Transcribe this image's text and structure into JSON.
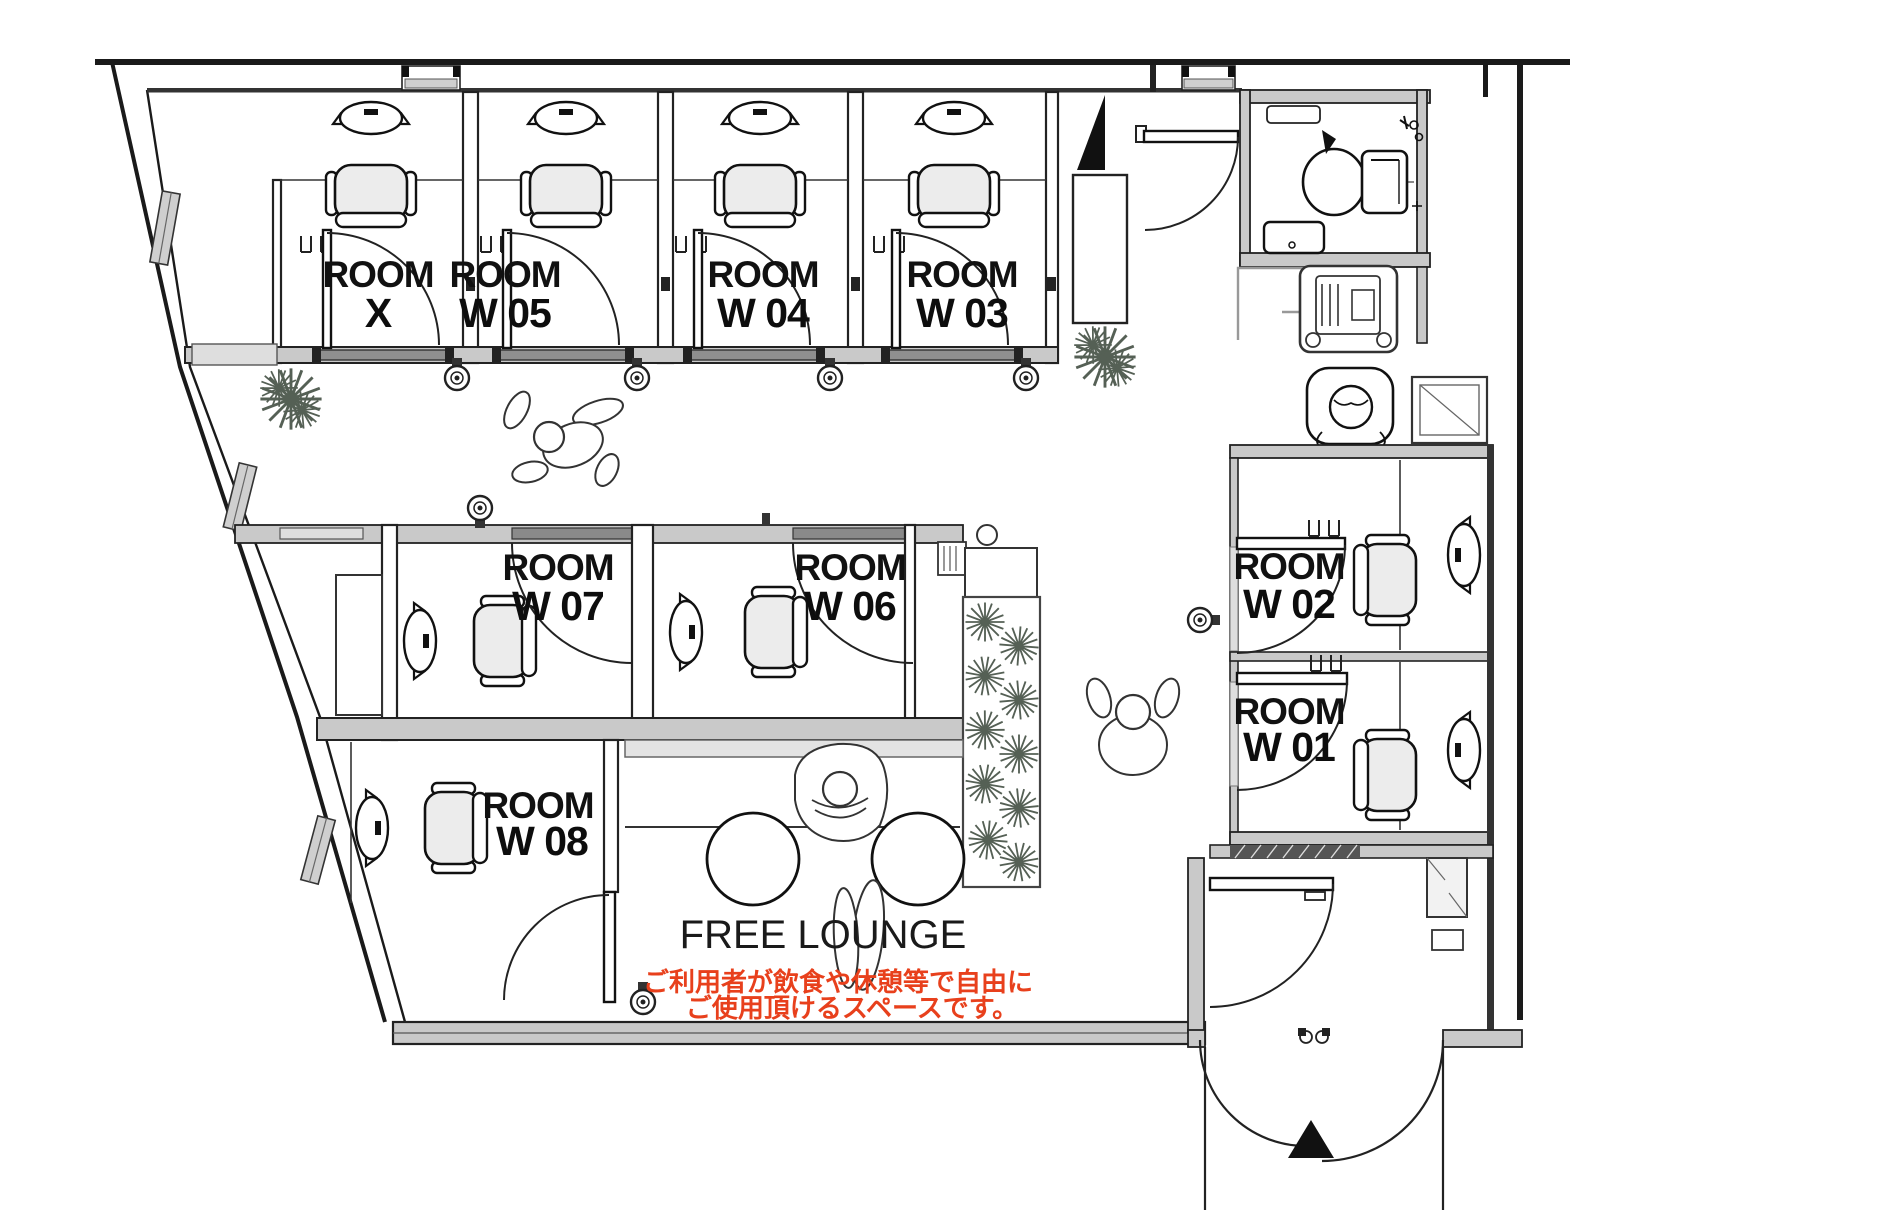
{
  "plan_title": "Shared office floor plan",
  "colors": {
    "line": "#1a1a1a",
    "wall_fill": "#c9c9c9",
    "accent_red": "#e8401c",
    "seat_fill": "#ececec"
  },
  "rooms": {
    "room_x": {
      "line1": "ROOM",
      "line2": "X"
    },
    "room_w05": {
      "line1": "ROOM",
      "line2": "W 05"
    },
    "room_w04": {
      "line1": "ROOM",
      "line2": "W 04"
    },
    "room_w03": {
      "line1": "ROOM",
      "line2": "W 03"
    },
    "room_w07": {
      "line1": "ROOM",
      "line2": "W 07"
    },
    "room_w06": {
      "line1": "ROOM",
      "line2": "W 06"
    },
    "room_w02": {
      "line1": "ROOM",
      "line2": "W 02"
    },
    "room_w01": {
      "line1": "ROOM",
      "line2": "W 01"
    },
    "room_w08": {
      "line1": "ROOM",
      "line2": "W 08"
    }
  },
  "lounge": {
    "title": "FREE LOUNGE",
    "note_line1": "ご利用者が飲食や休憩等で自由に",
    "note_line2": "ご使用頂けるスペースです。"
  }
}
